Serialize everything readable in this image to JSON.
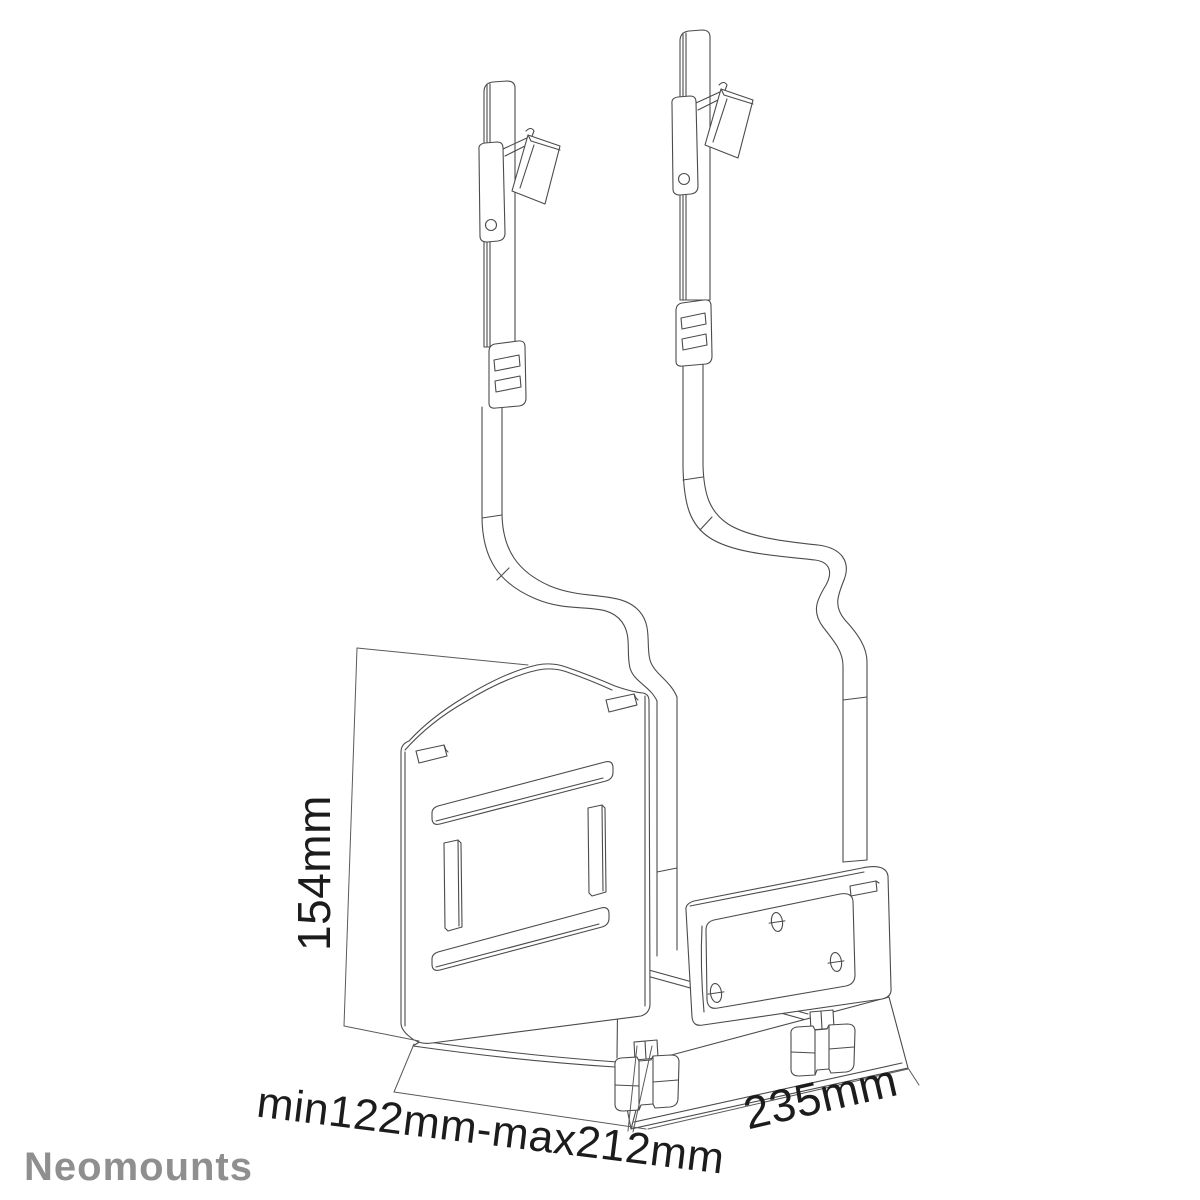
{
  "product_drawing": {
    "type": "technical line drawing",
    "subject": "under-desk CPU holder with two hanging adjustment straps, back plate, front bracket and two thumb-screw feet"
  },
  "dimensions": {
    "height_label": "154mm",
    "depth_label": "min122mm-max212mm",
    "width_label": "235mm"
  },
  "branding": {
    "logo": "Neomounts"
  },
  "colors": {
    "background": "#ffffff",
    "line": "#4b4b4b",
    "dimension_text": "#1c1c1c",
    "logo": "#8f8f8f"
  }
}
